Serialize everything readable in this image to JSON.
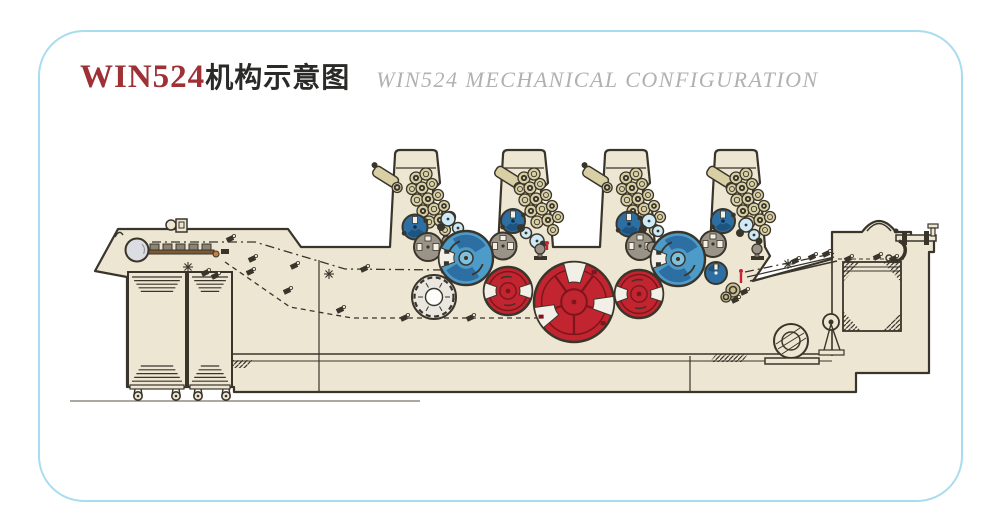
{
  "frame": {
    "border_color": "#a9dcee"
  },
  "title": {
    "model": "WIN524",
    "cn_suffix": "机构示意图",
    "en": "WIN524 MECHANICAL CONFIGURATION"
  },
  "palette": {
    "body": "#ece6d3",
    "outline": "#3a352b",
    "paper": "#f2efe6",
    "blue": "#4d9bc8",
    "blue_dark": "#2e6fa3",
    "blue_deep": "#1d5480",
    "blue_light": "#7fc0dd",
    "red": "#c2252f",
    "red_dark": "#7e151d",
    "damp": "#cdeaf6",
    "gray": "#9a9488",
    "roller": "#d9cfa4",
    "roller_olive": "#c8be8e",
    "white_cyl": "#e9e7e0",
    "drum": "#dcdde3",
    "rail_brown": "#7a5a35",
    "rail_orange": "#c97f3d",
    "ground": "#7a7468"
  },
  "machine": {
    "towers": [
      {
        "x": 390
      },
      {
        "x": 498
      },
      {
        "x": 600
      },
      {
        "x": 710
      }
    ],
    "roller_pattern": [
      [
        26,
        28,
        6,
        1
      ],
      [
        36,
        24,
        6,
        0
      ],
      [
        22,
        39,
        5.5,
        0
      ],
      [
        32,
        38,
        6,
        1
      ],
      [
        42,
        34,
        5.5,
        0
      ],
      [
        27,
        50,
        6,
        0
      ],
      [
        38,
        49,
        6,
        1
      ],
      [
        48,
        45,
        5.5,
        0
      ],
      [
        33,
        61,
        6,
        1
      ],
      [
        44,
        59,
        6,
        0
      ],
      [
        54,
        56,
        5.5,
        1
      ],
      [
        39,
        72,
        6,
        0
      ],
      [
        50,
        70,
        6,
        1
      ],
      [
        60,
        67,
        5.5,
        0
      ],
      [
        55,
        80,
        5.5,
        0
      ]
    ],
    "cylinders": [
      {
        "cx": 137,
        "cy": 250,
        "r": 11.5,
        "t": "drum",
        "name": "feeder-suction-drum"
      },
      {
        "cx": 415,
        "cy": 227,
        "r": 12.5,
        "t": "plate",
        "name": "plate-cylinder-1"
      },
      {
        "cx": 513,
        "cy": 221,
        "r": 12,
        "t": "plate",
        "name": "plate-cylinder-2"
      },
      {
        "cx": 629,
        "cy": 224,
        "r": 12.5,
        "t": "plate",
        "name": "plate-cylinder-3"
      },
      {
        "cx": 723,
        "cy": 221,
        "r": 12,
        "t": "plate",
        "name": "plate-cylinder-4"
      },
      {
        "cx": 428,
        "cy": 247,
        "r": 14,
        "t": "gray",
        "name": "distributor-cylinder-1"
      },
      {
        "cx": 503,
        "cy": 246,
        "r": 13.5,
        "t": "gray",
        "name": "distributor-cylinder-2"
      },
      {
        "cx": 640,
        "cy": 246,
        "r": 14,
        "t": "gray",
        "name": "distributor-cylinder-3"
      },
      {
        "cx": 713,
        "cy": 244,
        "r": 13,
        "t": "gray",
        "name": "distributor-cylinder-4"
      },
      {
        "cx": 448,
        "cy": 219,
        "r": 7,
        "t": "dampL",
        "name": "dampening-roller"
      },
      {
        "cx": 458,
        "cy": 228,
        "r": 5.5,
        "t": "dampL",
        "name": "dampening-roller"
      },
      {
        "cx": 526,
        "cy": 233,
        "r": 5.5,
        "t": "dampL",
        "name": "dampening-roller"
      },
      {
        "cx": 537,
        "cy": 241,
        "r": 7,
        "t": "dampL",
        "name": "dampening-roller"
      },
      {
        "cx": 649,
        "cy": 221,
        "r": 7,
        "t": "dampL",
        "name": "dampening-roller"
      },
      {
        "cx": 658,
        "cy": 231,
        "r": 5.5,
        "t": "dampL",
        "name": "dampening-roller"
      },
      {
        "cx": 746,
        "cy": 225,
        "r": 7,
        "t": "dampL",
        "name": "dampening-roller"
      },
      {
        "cx": 754,
        "cy": 235,
        "r": 5.5,
        "t": "dampL",
        "name": "dampening-roller"
      },
      {
        "cx": 441,
        "cy": 227,
        "r": 4,
        "t": "dampS",
        "name": "roller-dark"
      },
      {
        "cx": 463,
        "cy": 237,
        "r": 3.5,
        "t": "dampS",
        "name": "roller-dark"
      },
      {
        "cx": 521,
        "cy": 228,
        "r": 4,
        "t": "dampS",
        "name": "roller-dark"
      },
      {
        "cx": 543,
        "cy": 244,
        "r": 3.5,
        "t": "dampS",
        "name": "roller-dark"
      },
      {
        "cx": 643,
        "cy": 229,
        "r": 4,
        "t": "dampS",
        "name": "roller-dark"
      },
      {
        "cx": 663,
        "cy": 240,
        "r": 3.5,
        "t": "dampS",
        "name": "roller-dark"
      },
      {
        "cx": 740,
        "cy": 233,
        "r": 4,
        "t": "dampS",
        "name": "roller-dark"
      },
      {
        "cx": 759,
        "cy": 241,
        "r": 3.5,
        "t": "dampS",
        "name": "roller-dark"
      },
      {
        "cx": 447,
        "cy": 241,
        "r": 5,
        "t": "grayS",
        "name": "roller-small"
      },
      {
        "cx": 540,
        "cy": 249,
        "r": 5,
        "t": "grayS",
        "name": "roller-small"
      },
      {
        "cx": 652,
        "cy": 247,
        "r": 5,
        "t": "grayS",
        "name": "roller-small"
      },
      {
        "cx": 757,
        "cy": 249,
        "r": 5,
        "t": "grayS",
        "name": "roller-small"
      },
      {
        "cx": 733,
        "cy": 290,
        "r": 7,
        "t": "rollerO",
        "name": "delivery-roller"
      },
      {
        "cx": 726,
        "cy": 297,
        "r": 5,
        "t": "rollerO",
        "name": "delivery-roller"
      },
      {
        "cx": 434,
        "cy": 297,
        "r": 22,
        "t": "scallop",
        "name": "transfer-drum"
      },
      {
        "cx": 466,
        "cy": 258,
        "r": 27,
        "t": "blanket",
        "name": "blanket-cylinder-1"
      },
      {
        "cx": 678,
        "cy": 259,
        "r": 27,
        "t": "blanket",
        "name": "blanket-cylinder-2"
      },
      {
        "cx": 508,
        "cy": 291,
        "r": 24,
        "t": "red",
        "name": "impression-cylinder-1"
      },
      {
        "cx": 639,
        "cy": 294,
        "r": 24,
        "t": "red",
        "name": "impression-cylinder-2"
      },
      {
        "cx": 574,
        "cy": 302,
        "r": 40,
        "t": "redL",
        "name": "central-transfer-cylinder"
      },
      {
        "cx": 716,
        "cy": 273,
        "r": 11,
        "t": "sblue",
        "name": "delivery-cylinder"
      }
    ],
    "stands": [
      [
        441,
        244
      ],
      [
        534,
        252
      ],
      [
        646,
        250
      ],
      [
        751,
        252
      ]
    ],
    "fittings": [
      [
        230,
        239
      ],
      [
        252,
        259
      ],
      [
        294,
        266
      ],
      [
        364,
        269
      ],
      [
        444,
        270
      ],
      [
        250,
        272
      ],
      [
        287,
        291
      ],
      [
        340,
        310
      ],
      [
        404,
        318
      ],
      [
        470,
        318
      ],
      [
        795,
        261
      ],
      [
        812,
        257
      ],
      [
        826,
        254
      ],
      [
        848,
        259
      ],
      [
        877,
        257
      ],
      [
        893,
        259
      ],
      [
        735,
        300
      ],
      [
        744,
        292
      ],
      [
        205,
        273
      ],
      [
        215,
        276
      ]
    ],
    "stars": [
      [
        188,
        267
      ],
      [
        329,
        274
      ],
      [
        788,
        264
      ]
    ],
    "red_marks": [
      [
        741,
        271,
        741,
        283
      ],
      [
        547,
        243,
        547,
        250
      ]
    ],
    "paths": {
      "dashdot_feed": "M152,242 L255,242 L345,269 L448,270",
      "dashed_feed": "M225,262 L290,307 L352,318 L560,318",
      "dashdot_delivery": "M745,272 L836,253",
      "dashed_stack": "M838,259 L904,259"
    },
    "casters_x": [
      138,
      176,
      198,
      226
    ]
  }
}
